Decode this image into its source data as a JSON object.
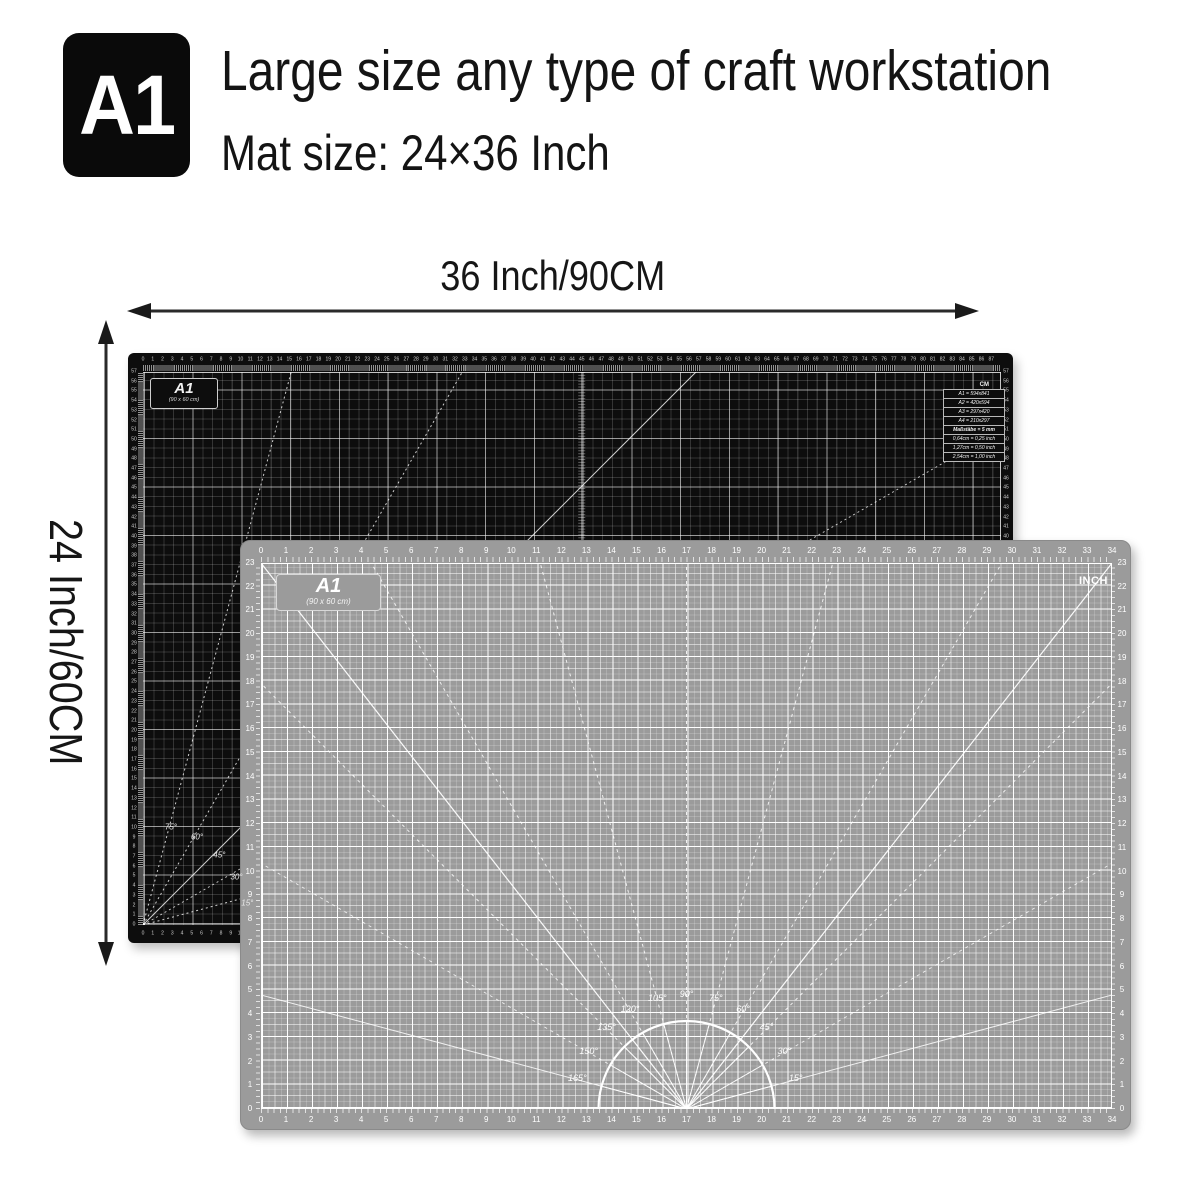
{
  "header": {
    "badge": "A1",
    "title": "Large size any type of craft workstation",
    "subtitle": "Mat size: 24×36 Inch"
  },
  "dimensions": {
    "width_label": "36 Inch/90CM",
    "height_label": "24 Inch/60CM"
  },
  "black_mat": {
    "name_label": "A1",
    "size_label": "(90 x 60 cm)",
    "unit_label": "CM",
    "table_rows": [
      "A1 = 594x841",
      "A2 = 420x594",
      "A3 = 297x420",
      "A4 = 210x297",
      "Maßstäbe = 5 mm",
      "0,64cm = 0,25 inch",
      "1,27cm = 0,50 inch",
      "2,54cm = 1,00 inch"
    ],
    "angles": [
      {
        "deg": 75,
        "label": "75°"
      },
      {
        "deg": 60,
        "label": "60°"
      },
      {
        "deg": 45,
        "label": "45°"
      },
      {
        "deg": 30,
        "label": "30°"
      },
      {
        "deg": 15,
        "label": "15°"
      }
    ],
    "rulers": {
      "top": {
        "min": 0,
        "max": 87
      },
      "left": {
        "min": 0,
        "max": 57
      },
      "right": {
        "min": 0,
        "max": 57
      },
      "bottom": {
        "min": 0,
        "max": 13
      }
    }
  },
  "gray_mat": {
    "name_label": "A1",
    "size_label": "(90 x 60 cm)",
    "unit_label": "INCH",
    "angles": [
      {
        "deg": 165,
        "label": "165°"
      },
      {
        "deg": 150,
        "label": "150°"
      },
      {
        "deg": 135,
        "label": "135°"
      },
      {
        "deg": 120,
        "label": "120°"
      },
      {
        "deg": 105,
        "label": "105°"
      },
      {
        "deg": 90,
        "label": "90°"
      },
      {
        "deg": 75,
        "label": "75°"
      },
      {
        "deg": 60,
        "label": "60°"
      },
      {
        "deg": 45,
        "label": "45°"
      },
      {
        "deg": 30,
        "label": "30°"
      },
      {
        "deg": 15,
        "label": "15°"
      }
    ],
    "rulers": {
      "top": {
        "min": 0,
        "max": 34
      },
      "bottom": {
        "min": 0,
        "max": 34
      },
      "left": {
        "min": 0,
        "max": 23
      },
      "right": {
        "min": 0,
        "max": 23
      }
    }
  },
  "colors": {
    "mat_black": "#0d0d0d",
    "mat_gray": "#9b9b9b",
    "ink": "#141414",
    "grid_white": "#ffffff"
  }
}
